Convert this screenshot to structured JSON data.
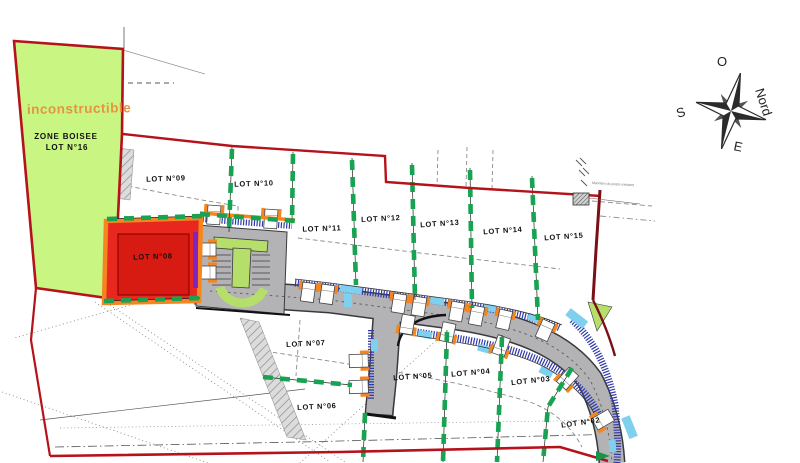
{
  "colors": {
    "boundary": "#b5121b",
    "zone": "#c9f582",
    "lotred": "#e8281e",
    "lotred2": "#d81b12",
    "road": "#b3b3b6",
    "ink": "#111111",
    "orange": "#f5861f",
    "hedge": "#18a352",
    "skyblue": "#7fd0ee",
    "navy": "#3038a8",
    "island": "#b5df6a",
    "warnorange": "#e59440"
  },
  "zone": {
    "warning": "inconstructible",
    "name": "ZONE BOISEE",
    "lot": "LOT N°16"
  },
  "annotation": {
    "note": "Maintien du poste existant"
  },
  "compass": {
    "o": "O",
    "nord": "Nord",
    "s": "S",
    "e": "E"
  },
  "lots": [
    {
      "id": "09",
      "label": "LOT N°09",
      "x": 166,
      "y": 181,
      "rot": -2
    },
    {
      "id": "10",
      "label": "LOT N°10",
      "x": 254,
      "y": 186,
      "rot": -2
    },
    {
      "id": "11",
      "label": "LOT N°11",
      "x": 322,
      "y": 231,
      "rot": -2
    },
    {
      "id": "12",
      "label": "LOT N°12",
      "x": 381,
      "y": 221,
      "rot": -3
    },
    {
      "id": "13",
      "label": "LOT N°13",
      "x": 440,
      "y": 226,
      "rot": -4
    },
    {
      "id": "14",
      "label": "LOT N°14",
      "x": 503,
      "y": 233,
      "rot": -4
    },
    {
      "id": "15",
      "label": "LOT N°15",
      "x": 564,
      "y": 239,
      "rot": -4
    },
    {
      "id": "08",
      "label": "LOT N°08",
      "x": 153,
      "y": 259,
      "rot": -2
    },
    {
      "id": "07",
      "label": "LOT N°07",
      "x": 306,
      "y": 346,
      "rot": -3
    },
    {
      "id": "06",
      "label": "LOT N°06",
      "x": 317,
      "y": 409,
      "rot": -3
    },
    {
      "id": "05",
      "label": "LOT N°05",
      "x": 413,
      "y": 379,
      "rot": -4
    },
    {
      "id": "04",
      "label": "LOT N°04",
      "x": 471,
      "y": 375,
      "rot": -5
    },
    {
      "id": "03",
      "label": "LOT N°03",
      "x": 531,
      "y": 383,
      "rot": -6
    },
    {
      "id": "02",
      "label": "LOT N°02",
      "x": 581,
      "y": 425,
      "rot": -8
    }
  ]
}
